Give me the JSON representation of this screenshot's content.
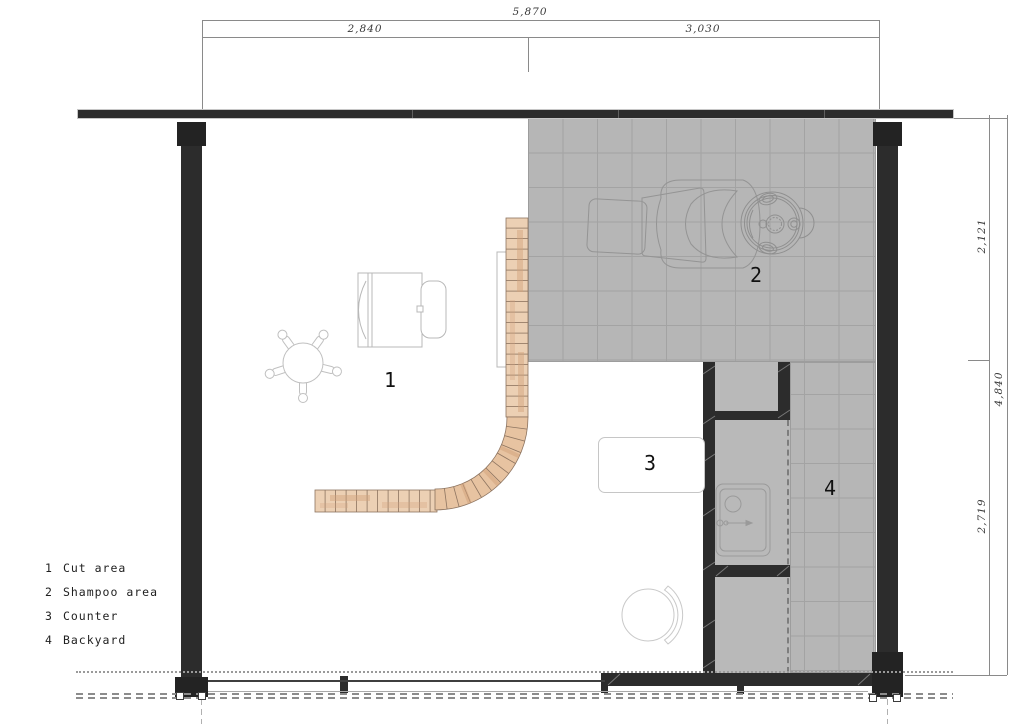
{
  "drawing": {
    "dimensions": {
      "top": {
        "total": "5,870",
        "left_segment": "2,840",
        "right_segment": "3,030"
      },
      "right": {
        "total": "4,840",
        "top_segment": "2,121",
        "bottom_segment": "2,719"
      }
    },
    "legend": {
      "items": [
        {
          "number": "1",
          "label": "Cut area"
        },
        {
          "number": "2",
          "label": "Shampoo area"
        },
        {
          "number": "3",
          "label": "Counter"
        },
        {
          "number": "4",
          "label": "Backyard"
        }
      ]
    },
    "area_labels": {
      "cut_area": "1",
      "shampoo_area": "2",
      "counter": "3",
      "backyard": "4"
    },
    "colors": {
      "wall": "#2c2c2c",
      "tile_fill": "#b6b6b6",
      "tile_line": "#a3a3a3",
      "wood_light": "#f0dcc6",
      "wood_mid": "#e7c3a1",
      "wood_dark": "#d3a27b",
      "outline_gray": "#9a9a9a",
      "background": "#ffffff"
    }
  }
}
